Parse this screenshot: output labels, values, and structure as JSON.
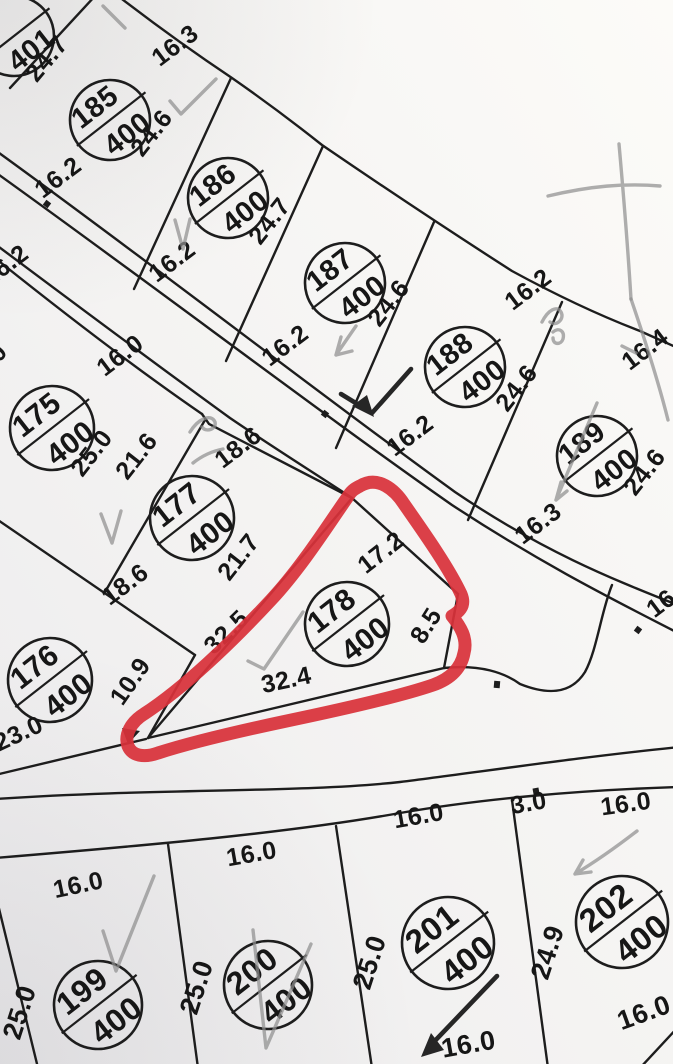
{
  "map": {
    "title": "cadastral parcel plan",
    "colors": {
      "line": "#1d1d1d",
      "pencil": "#8f8f8f",
      "ink": "#262626",
      "highlight": "#d8323a",
      "paper_light": "#fbfaf8",
      "paper_dark": "#efeef0"
    },
    "highlight": {
      "around_parcel": "178",
      "style": "hand-drawn red loop"
    },
    "parcels": [
      {
        "id": "",
        "area": "401",
        "cx": 14,
        "cy": 36,
        "r": 40
      },
      {
        "id": "185",
        "area": "400",
        "cx": 110,
        "cy": 120,
        "r": 40
      },
      {
        "id": "186",
        "area": "400",
        "cx": 228,
        "cy": 198,
        "r": 40
      },
      {
        "id": "187",
        "area": "400",
        "cx": 345,
        "cy": 283,
        "r": 40
      },
      {
        "id": "188",
        "area": "400",
        "cx": 465,
        "cy": 367,
        "r": 40
      },
      {
        "id": "189",
        "area": "400",
        "cx": 597,
        "cy": 456,
        "r": 40
      },
      {
        "id": "175",
        "area": "400",
        "cx": 52,
        "cy": 428,
        "r": 42
      },
      {
        "id": "177",
        "area": "400",
        "cx": 192,
        "cy": 518,
        "r": 42
      },
      {
        "id": "176",
        "area": "400",
        "cx": 50,
        "cy": 680,
        "r": 42
      },
      {
        "id": "178",
        "area": "400",
        "cx": 347,
        "cy": 624,
        "r": 42
      },
      {
        "id": "199",
        "area": "400",
        "cx": 98,
        "cy": 1005,
        "r": 44
      },
      {
        "id": "200",
        "area": "400",
        "cx": 268,
        "cy": 985,
        "r": 44
      },
      {
        "id": "201",
        "area": "400",
        "cx": 448,
        "cy": 943,
        "r": 46
      },
      {
        "id": "202",
        "area": "400",
        "cx": 622,
        "cy": 922,
        "r": 46
      }
    ],
    "dimensions": [
      {
        "text": "24.7",
        "x": 53,
        "y": 64,
        "rot": -50
      },
      {
        "text": "16.3",
        "x": 180,
        "y": 52,
        "rot": -37
      },
      {
        "text": "24.6",
        "x": 158,
        "y": 138,
        "rot": -52
      },
      {
        "text": "16.2",
        "x": 63,
        "y": 184,
        "rot": -37
      },
      {
        "text": "24.7",
        "x": 276,
        "y": 226,
        "rot": -52
      },
      {
        "text": "16.2",
        "x": 177,
        "y": 268,
        "rot": -37
      },
      {
        "text": "16.2",
        "x": 10,
        "y": 272,
        "rot": -37
      },
      {
        "text": "24.6",
        "x": 395,
        "y": 308,
        "rot": -52
      },
      {
        "text": "16.2",
        "x": 290,
        "y": 352,
        "rot": -37
      },
      {
        "text": "24.6",
        "x": 523,
        "y": 393,
        "rot": -52
      },
      {
        "text": "16.2",
        "x": 415,
        "y": 442,
        "rot": -37
      },
      {
        "text": "16.2",
        "x": 533,
        "y": 296,
        "rot": -37
      },
      {
        "text": "16.4",
        "x": 650,
        "y": 356,
        "rot": -37
      },
      {
        "text": "24.6",
        "x": 651,
        "y": 477,
        "rot": -52
      },
      {
        "text": "16.3",
        "x": 543,
        "y": 530,
        "rot": -37
      },
      {
        "text": "16",
        "x": 666,
        "y": 610,
        "rot": -37
      },
      {
        "text": "16.0",
        "x": 125,
        "y": 362,
        "rot": -37
      },
      {
        "text": "0",
        "x": 4,
        "y": 358,
        "rot": -50
      },
      {
        "text": "25.0",
        "x": 98,
        "y": 458,
        "rot": -52
      },
      {
        "text": "21.6",
        "x": 143,
        "y": 461,
        "rot": -52
      },
      {
        "text": "18.6",
        "x": 243,
        "y": 454,
        "rot": -37
      },
      {
        "text": "21.7",
        "x": 245,
        "y": 562,
        "rot": -52
      },
      {
        "text": "18.6",
        "x": 130,
        "y": 591,
        "rot": -37
      },
      {
        "text": "10.9",
        "x": 137,
        "y": 686,
        "rot": -55
      },
      {
        "text": "23.0",
        "x": 22,
        "y": 741,
        "rot": -25
      },
      {
        "text": "17.2",
        "x": 386,
        "y": 559,
        "rot": -38
      },
      {
        "text": "8.5",
        "x": 433,
        "y": 630,
        "rot": -58
      },
      {
        "text": "32.5",
        "x": 232,
        "y": 638,
        "rot": -44
      },
      {
        "text": "32.4",
        "x": 288,
        "y": 688,
        "rot": -12
      },
      {
        "text": "16.0",
        "x": 80,
        "y": 893,
        "rot": -12
      },
      {
        "text": "25.0",
        "x": 28,
        "y": 1015,
        "rot": -72,
        "fs": 27
      },
      {
        "text": "16.0",
        "x": 253,
        "y": 862,
        "rot": -10
      },
      {
        "text": "25.0",
        "x": 205,
        "y": 990,
        "rot": -72,
        "fs": 27
      },
      {
        "text": "16.0",
        "x": 420,
        "y": 824,
        "rot": -10
      },
      {
        "text": "25.0",
        "x": 378,
        "y": 965,
        "rot": -72,
        "fs": 27
      },
      {
        "text": "3.0",
        "x": 530,
        "y": 811,
        "rot": -10
      },
      {
        "text": "16.0",
        "x": 627,
        "y": 812,
        "rot": -8
      },
      {
        "text": "24.9",
        "x": 556,
        "y": 955,
        "rot": -72,
        "fs": 27
      },
      {
        "text": "16.0",
        "x": 470,
        "y": 1053,
        "rot": -10,
        "fs": 27
      },
      {
        "text": "16.0",
        "x": 647,
        "y": 1021,
        "rot": -20,
        "fs": 27
      }
    ]
  }
}
